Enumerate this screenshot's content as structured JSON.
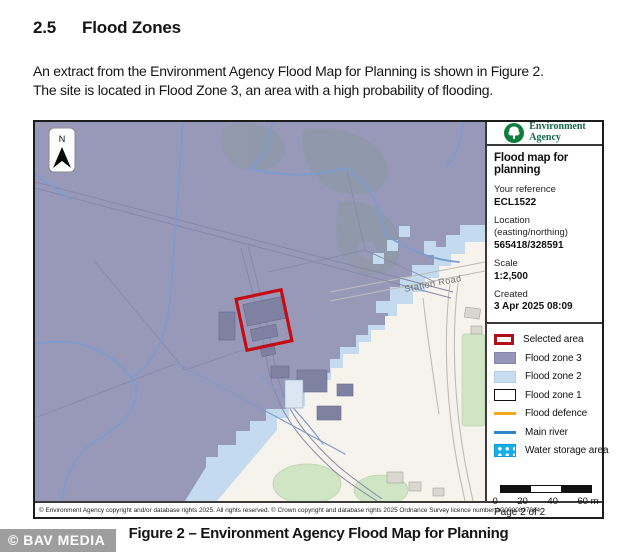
{
  "document": {
    "section_number": "2.5",
    "section_title": "Flood Zones",
    "paragraph_lines": [
      "An extract from the Environment Agency Flood Map for Planning is shown in Figure 2.",
      "The site is located in Flood Zone 3, an area with a high probability of flooding."
    ],
    "figure_caption": "Figure 2 – Environment Agency Flood Map for Planning",
    "watermark": "© BAV MEDIA"
  },
  "map": {
    "north_label": "N",
    "road_label": "Station Road",
    "copyright": "© Environment Agency copyright and/or database rights 2025. All rights reserved.   © Crown copyright and database rights 2025 Ordnance Survey licence number AC0000807064."
  },
  "legend": {
    "logo": {
      "line1": "Environment",
      "line2": "Agency"
    },
    "title": "Flood map for planning",
    "fields": [
      {
        "label": "Your reference",
        "value": "ECL1522"
      },
      {
        "label": "Location (easting/northing)",
        "value": "565418/328591"
      },
      {
        "label": "Scale",
        "value": "1:2,500"
      },
      {
        "label": "Created",
        "value": "3 Apr 2025 08:09"
      }
    ],
    "items": [
      {
        "label": "Selected area"
      },
      {
        "label": "Flood zone 3"
      },
      {
        "label": "Flood zone 2"
      },
      {
        "label": "Flood zone 1"
      },
      {
        "label": "Flood defence"
      },
      {
        "label": "Main river"
      },
      {
        "label": "Water storage area"
      }
    ],
    "scale_ticks": [
      "0",
      "20",
      "40",
      "60 m"
    ],
    "page_label": "Page 2 of 2"
  },
  "colors": {
    "flood_zone_3": "#9496b7",
    "flood_zone_2": "#c7ddf1",
    "flood_zone_1": "#ffffff",
    "flood_defence": "#f5a81c",
    "main_river": "#2e86c8",
    "water_storage": "#19aee8",
    "selected_area": "#b01116"
  }
}
